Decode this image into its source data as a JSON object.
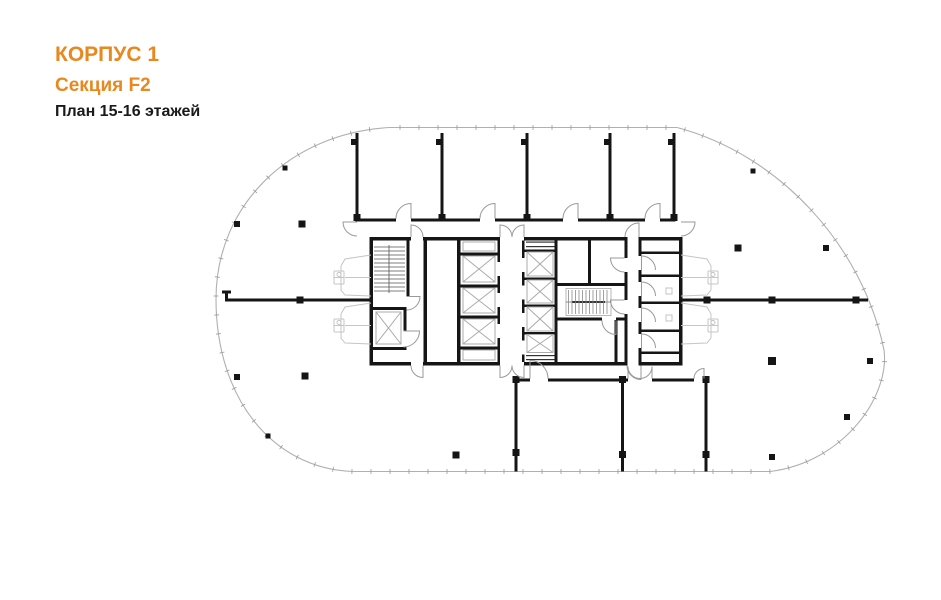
{
  "header": {
    "building": "КОРПУС 1",
    "section": "Секция F2",
    "floor_plan": "План 15-16 этажей"
  },
  "colors": {
    "accent_orange": "#E8881F",
    "title_black": "#1a1a1a",
    "wall_black": "#151515",
    "facade_gray": "#b0b0b0",
    "door_arc_gray": "#9a9a9a",
    "fixture_gray": "#c5c5c5",
    "background": "#ffffff"
  },
  "icons": {
    "filled-square": "structural column",
    "x-box": "elevator shaft",
    "hatched-band": "staircase",
    "quarter-arc": "door swing",
    "ticked-curve": "glazed facade with mullions"
  }
}
